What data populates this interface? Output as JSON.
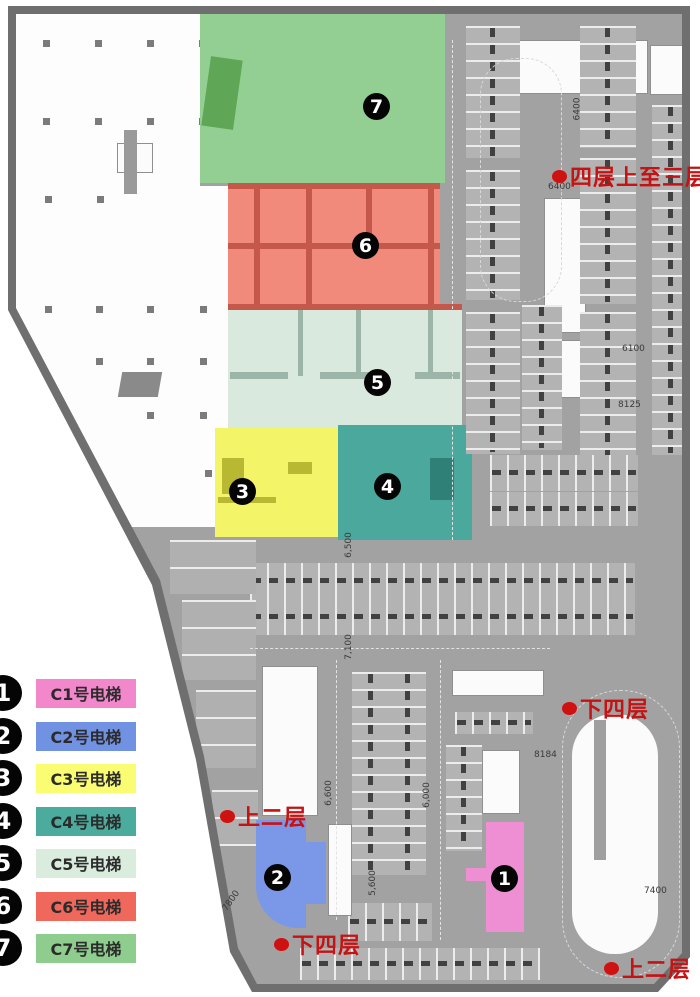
{
  "legend": {
    "items": [
      {
        "num": "1",
        "label": "C1号电梯",
        "color": "#f287cb"
      },
      {
        "num": "2",
        "label": "C2号电梯",
        "color": "#7191e3"
      },
      {
        "num": "3",
        "label": "C3号电梯",
        "color": "#fafc72"
      },
      {
        "num": "4",
        "label": "C4号电梯",
        "color": "#4bab9c"
      },
      {
        "num": "5",
        "label": "C5号电梯",
        "color": "#d9ecdd"
      },
      {
        "num": "6",
        "label": "C6号电梯",
        "color": "#f0685b"
      },
      {
        "num": "7",
        "label": "C7号电梯",
        "color": "#8ecd8e"
      }
    ]
  },
  "zones": {
    "c1": {
      "name": "C1号电梯",
      "fill": "#ef8fd3"
    },
    "c2": {
      "name": "C2号电梯",
      "fill": "#7b97e8"
    },
    "c3": {
      "name": "C3号电梯",
      "fill": "#f4f468"
    },
    "c4": {
      "name": "C4号电梯",
      "fill": "#4aa89c"
    },
    "c5": {
      "name": "C5号电梯",
      "fill": "#d9e9de"
    },
    "c6": {
      "name": "C6号电梯",
      "fill": "#f18a7a"
    },
    "c7": {
      "name": "C7号电梯",
      "fill": "#93cf93"
    }
  },
  "markers": [
    {
      "num": "1",
      "style": {
        "left": "491px",
        "top": "865px"
      }
    },
    {
      "num": "2",
      "style": {
        "left": "264px",
        "top": "864px"
      }
    },
    {
      "num": "3",
      "style": {
        "left": "229px",
        "top": "478px"
      }
    },
    {
      "num": "4",
      "style": {
        "left": "374px",
        "top": "473px"
      }
    },
    {
      "num": "5",
      "style": {
        "left": "364px",
        "top": "369px"
      }
    },
    {
      "num": "6",
      "style": {
        "left": "352px",
        "top": "232px"
      }
    },
    {
      "num": "7",
      "style": {
        "left": "363px",
        "top": "93px"
      }
    }
  ],
  "annotations": [
    {
      "text": "四层上至三层",
      "style": {
        "left": "552px",
        "top": "160px"
      }
    },
    {
      "text": "下四层",
      "style": {
        "left": "562px",
        "top": "692px"
      }
    },
    {
      "text": "上二层",
      "style": {
        "left": "220px",
        "top": "800px"
      }
    },
    {
      "text": "下四层",
      "style": {
        "left": "274px",
        "top": "928px"
      }
    },
    {
      "text": "上二层",
      "style": {
        "left": "604px",
        "top": "952px"
      }
    }
  ],
  "dimensions": [
    {
      "text": "6400",
      "style": {
        "left": "548px",
        "top": "182px"
      }
    },
    {
      "text": "6400",
      "style": {
        "left": "566px",
        "top": "104px",
        "transform": "rotate(-90deg)"
      }
    },
    {
      "text": "6100",
      "style": {
        "left": "622px",
        "top": "344px"
      }
    },
    {
      "text": "8125",
      "style": {
        "left": "618px",
        "top": "400px"
      }
    },
    {
      "text": "8184",
      "style": {
        "left": "534px",
        "top": "750px"
      }
    },
    {
      "text": "7400",
      "style": {
        "left": "644px",
        "top": "886px"
      }
    },
    {
      "text": "6,500",
      "style": {
        "left": "336px",
        "top": "540px",
        "transform": "rotate(-90deg)"
      }
    },
    {
      "text": "7,100",
      "style": {
        "left": "336px",
        "top": "642px",
        "transform": "rotate(-90deg)"
      }
    },
    {
      "text": "6,600",
      "style": {
        "left": "316px",
        "top": "788px",
        "transform": "rotate(-90deg)"
      }
    },
    {
      "text": "6,000",
      "style": {
        "left": "414px",
        "top": "790px",
        "transform": "rotate(-90deg)"
      }
    },
    {
      "text": "5,600",
      "style": {
        "left": "360px",
        "top": "878px",
        "transform": "rotate(-90deg)"
      }
    },
    {
      "text": "7800",
      "style": {
        "left": "220px",
        "top": "896px",
        "transform": "rotate(-55deg)"
      }
    }
  ]
}
